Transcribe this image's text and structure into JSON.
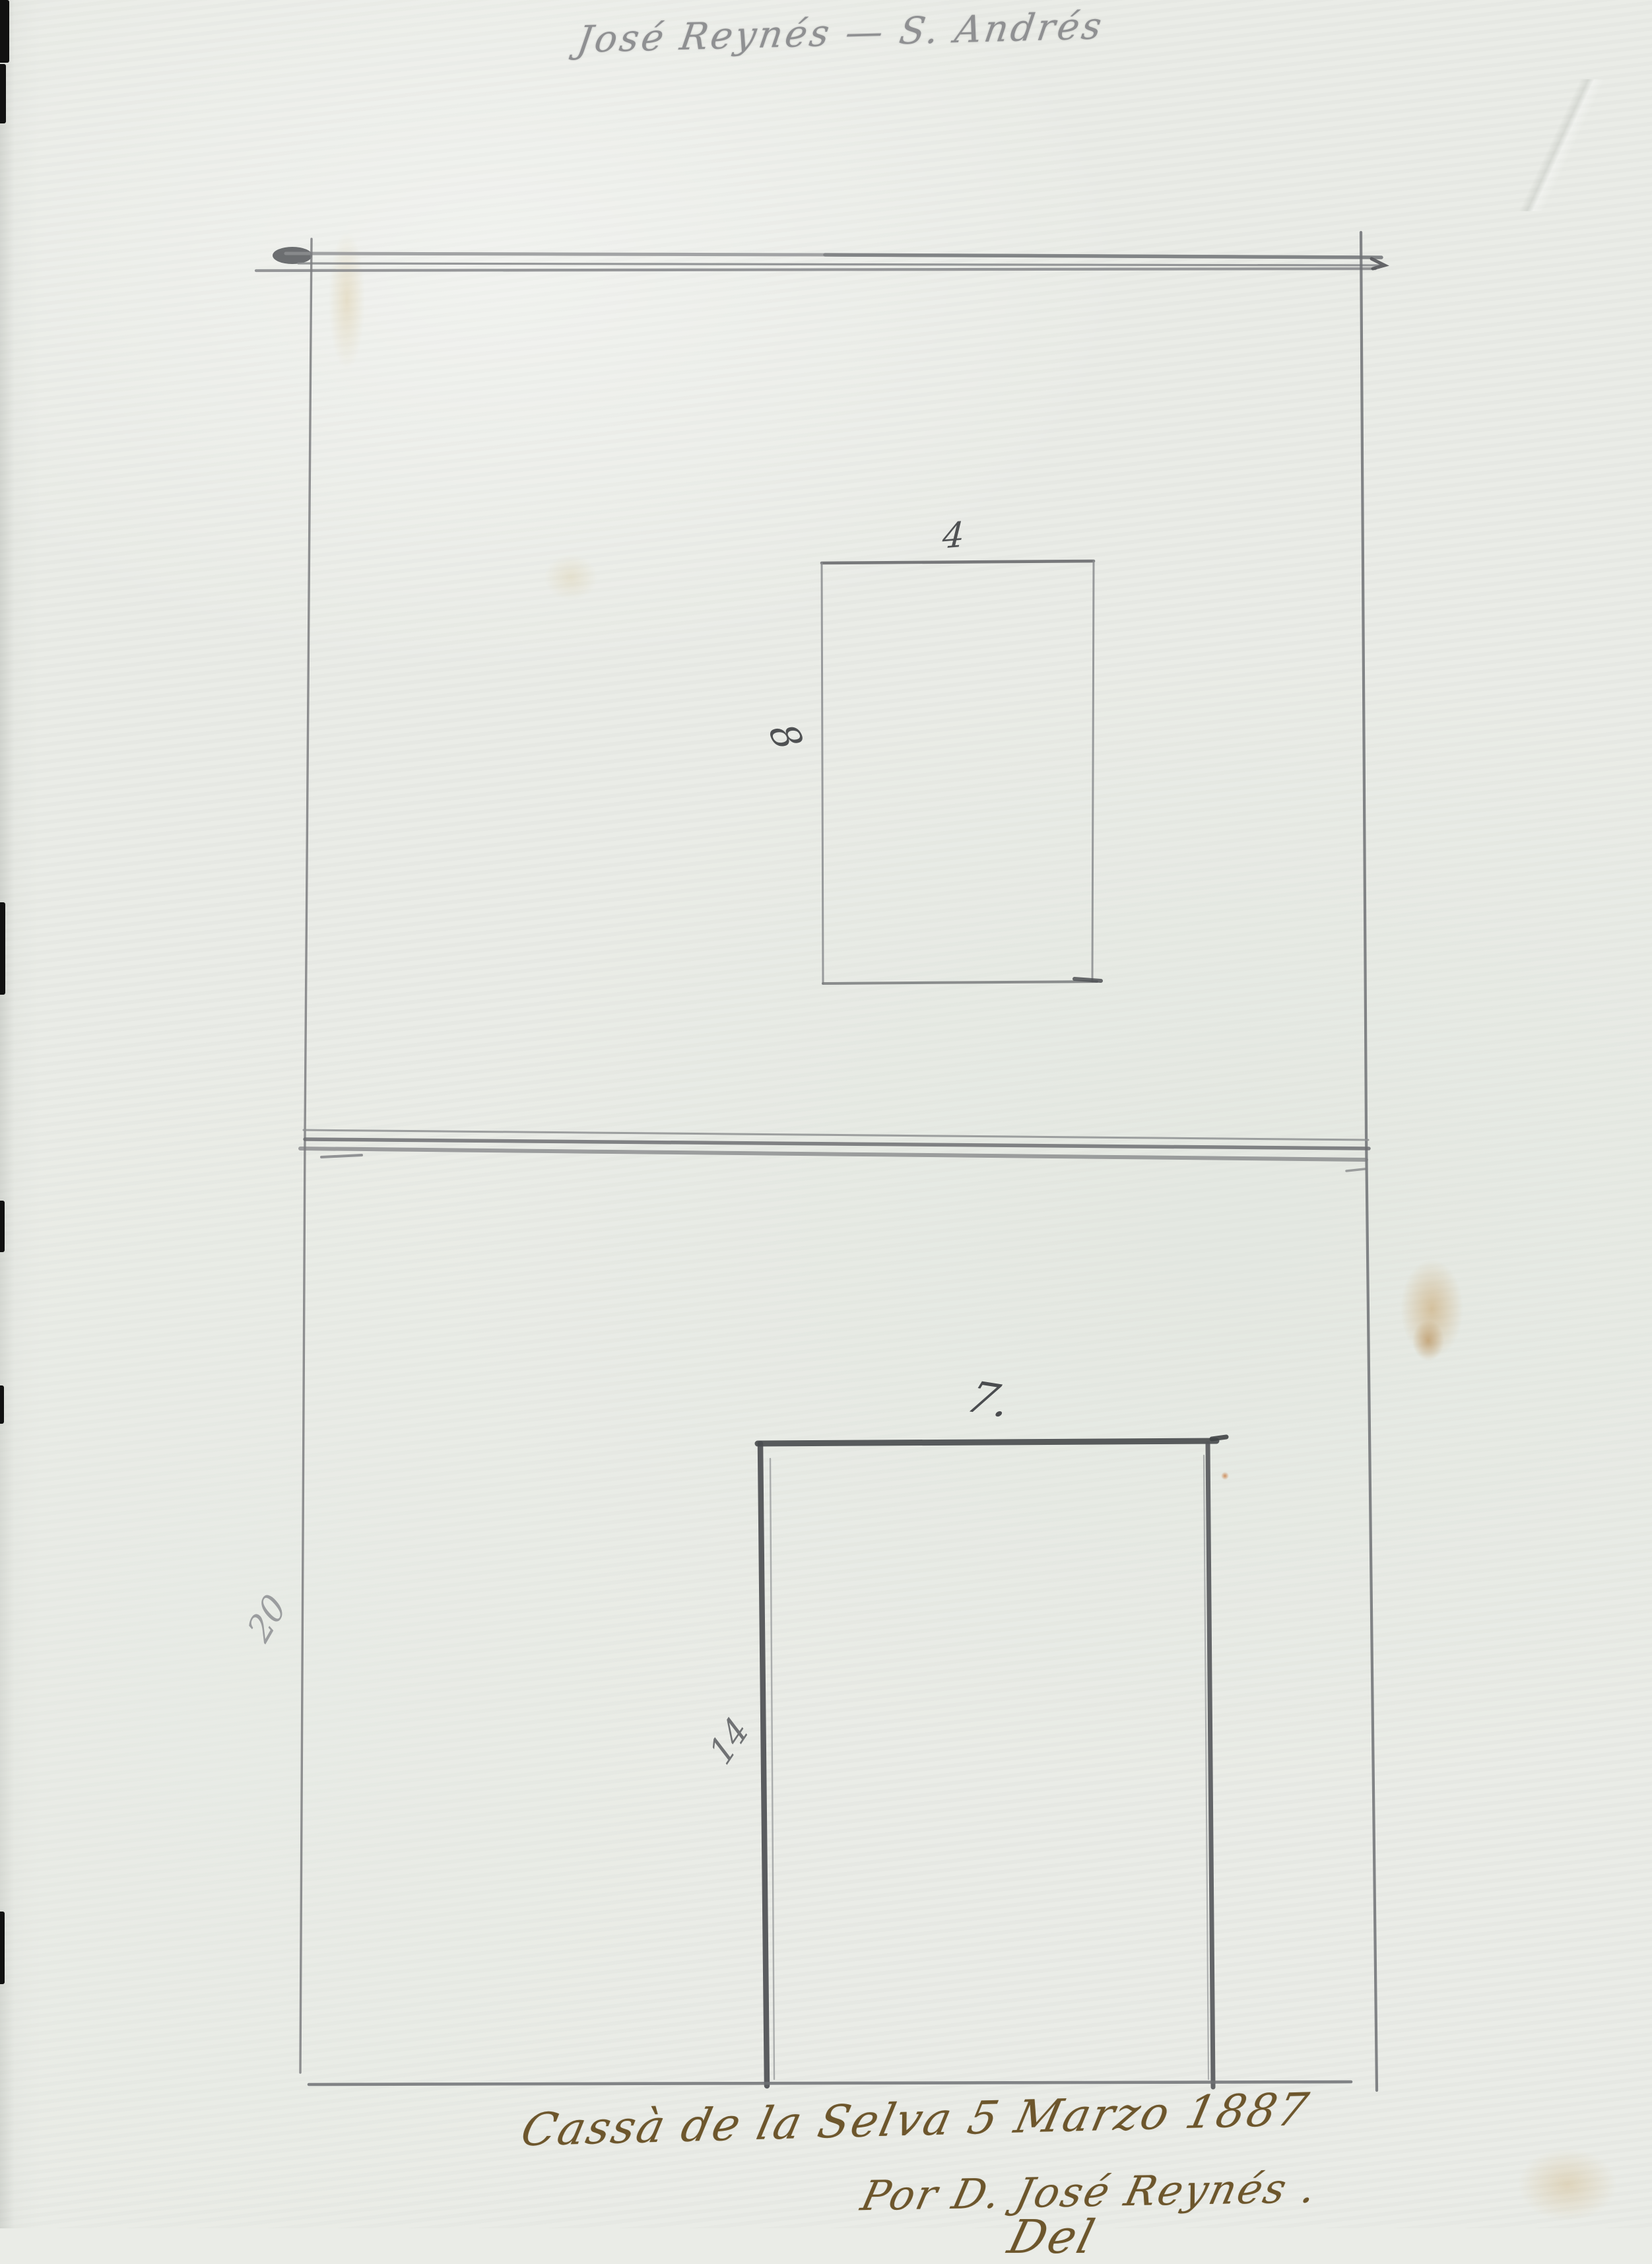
{
  "meta": {
    "description": "Scanned hand-drawn pencil sketch of two paneled elevations with dimensioned openings, signed in ink",
    "paper_color": "#e9ebe6",
    "pencil_color": "#6a6a6a",
    "ink_color": "#6d562c"
  },
  "inscriptions": {
    "top": "José Reynés — S. Andrés",
    "bottom_line1": "Cassà de la Selva 5 Marzo 1887",
    "bottom_line2": "Por D. José Reynés .",
    "bottom_line3_partial": "Del"
  },
  "sketch": {
    "upper_panel": {
      "opening_width_label": "4",
      "opening_height_label": "8"
    },
    "lower_panel": {
      "panel_height_label": "20",
      "opening_width_label": "7.",
      "opening_height_label": "14"
    }
  }
}
